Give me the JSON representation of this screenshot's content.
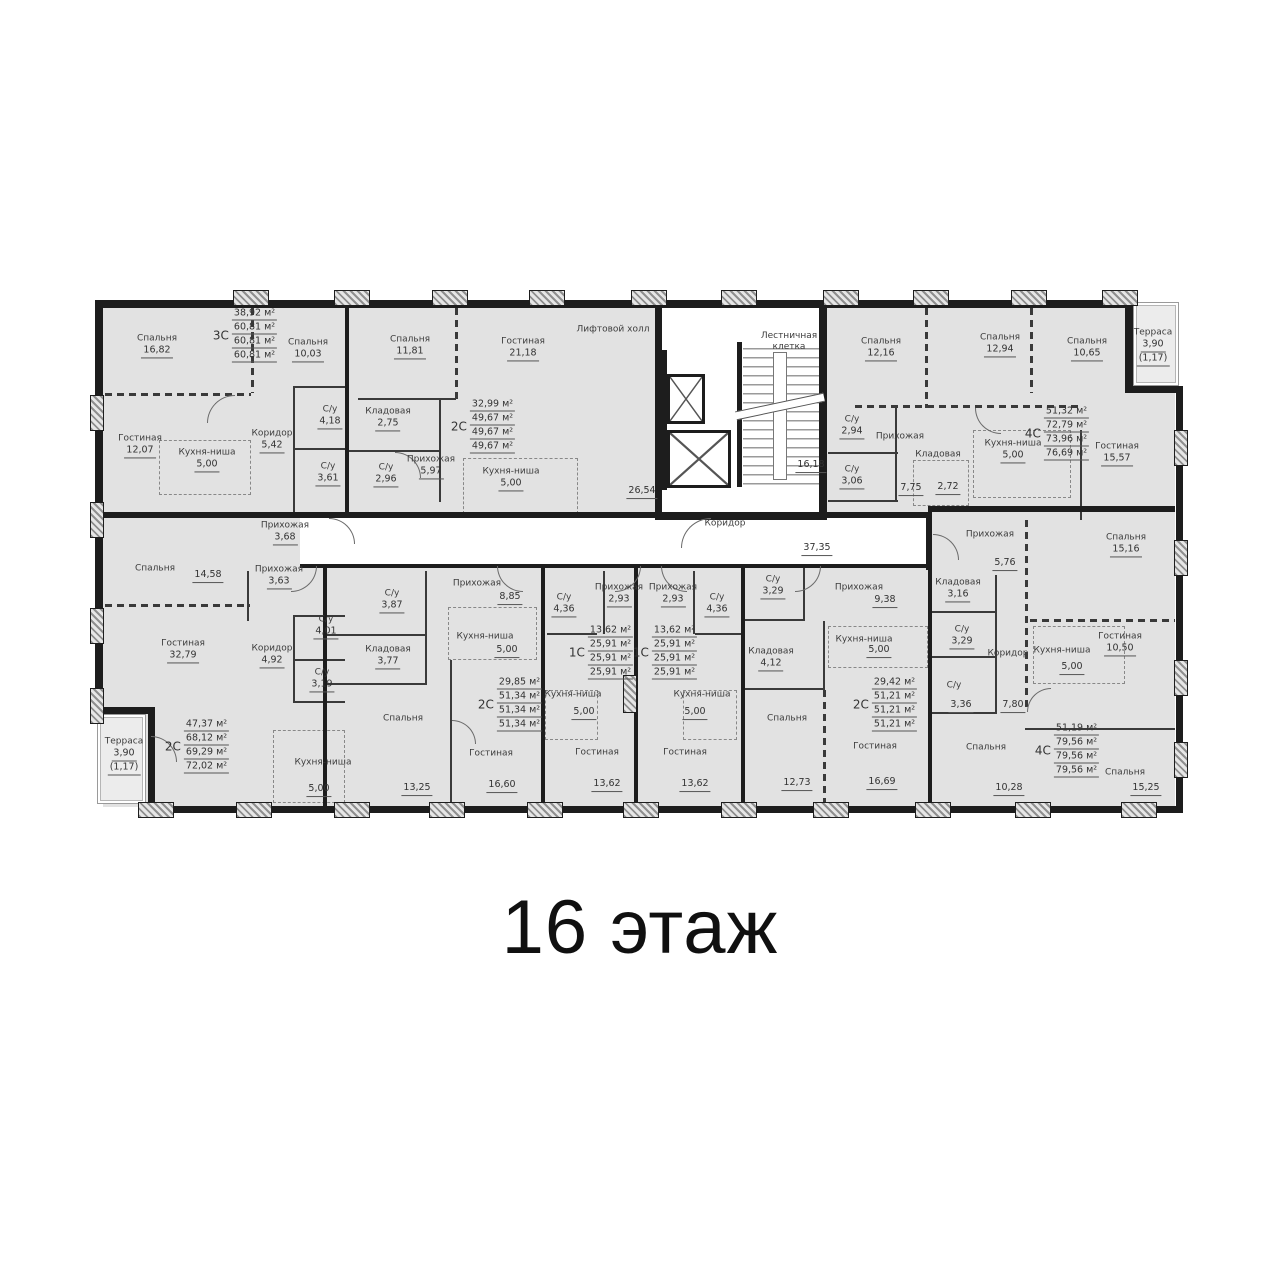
{
  "caption": "16 этаж",
  "core": {
    "elevator_hall": {
      "name": "Лифтовой холл",
      "area": "26,54"
    },
    "stairwell": {
      "name": "Лестничная клетка",
      "area": "16,18"
    },
    "corridor": {
      "name": "Коридор",
      "area": "37,35"
    }
  },
  "apartments": [
    {
      "type": "3С",
      "areas": [
        "38,92 м²",
        "60,81 м²",
        "60,81 м²",
        "60,81 м²"
      ],
      "rooms": [
        {
          "name": "Спальня",
          "area": "16,82"
        },
        {
          "name": "Спальня",
          "area": "10,03"
        },
        {
          "name": "Гостиная",
          "area": "12,07"
        },
        {
          "name": "Кухня-ниша",
          "area": "5,00"
        },
        {
          "name": "Коридор",
          "area": "5,42"
        },
        {
          "name": "С/у",
          "area": "4,18"
        },
        {
          "name": "С/у",
          "area": "3,61"
        },
        {
          "name": "Прихожая",
          "area": "3,68"
        }
      ]
    },
    {
      "type": "2С",
      "areas": [
        "32,99 м²",
        "49,67 м²",
        "49,67 м²",
        "49,67 м²"
      ],
      "rooms": [
        {
          "name": "Спальня",
          "area": "11,81"
        },
        {
          "name": "Гостиная",
          "area": "21,18"
        },
        {
          "name": "Кладовая",
          "area": "2,75"
        },
        {
          "name": "С/у",
          "area": "2,96"
        },
        {
          "name": "Прихожая",
          "area": "5,97"
        },
        {
          "name": "Кухня-ниша",
          "area": "5,00"
        }
      ]
    },
    {
      "type": "4С",
      "areas": [
        "51,32 м²",
        "72,79 м²",
        "73,96 м²",
        "76,69 м²"
      ],
      "rooms": [
        {
          "name": "Спальня",
          "area": "12,16"
        },
        {
          "name": "Спальня",
          "area": "12,94"
        },
        {
          "name": "Спальня",
          "area": "10,65"
        },
        {
          "name": "Терраса",
          "area": "3,90",
          "area2": "(1,17)"
        },
        {
          "name": "С/у",
          "area": "2,94"
        },
        {
          "name": "С/у",
          "area": "3,06"
        },
        {
          "name": "Прихожая",
          "area": "7,75"
        },
        {
          "name": "Кладовая",
          "area": "2,72"
        },
        {
          "name": "Кухня-ниша",
          "area": "5,00"
        },
        {
          "name": "Гостиная",
          "area": "15,57"
        }
      ]
    },
    {
      "type": "2С",
      "areas": [
        "47,37 м²",
        "68,12 м²",
        "69,29 м²",
        "72,02 м²"
      ],
      "rooms": [
        {
          "name": "Спальня",
          "area": "14,58"
        },
        {
          "name": "Прихожая",
          "area": "3,63"
        },
        {
          "name": "Гостиная",
          "area": "32,79"
        },
        {
          "name": "Коридор",
          "area": "4,92"
        },
        {
          "name": "С/у",
          "area": "4,01"
        },
        {
          "name": "С/у",
          "area": "3,19"
        },
        {
          "name": "Кухня-ниша",
          "area": "5,00"
        },
        {
          "name": "Терраса",
          "area": "3,90",
          "area2": "(1,17)"
        }
      ]
    },
    {
      "type": "2С",
      "areas": [
        "29,85 м²",
        "51,34 м²",
        "51,34 м²",
        "51,34 м²"
      ],
      "rooms": [
        {
          "name": "С/у",
          "area": "3,87"
        },
        {
          "name": "Прихожая",
          "area": "8,85"
        },
        {
          "name": "Кухня-ниша",
          "area": "5,00"
        },
        {
          "name": "Кладовая",
          "area": "3,77"
        },
        {
          "name": "Спальня",
          "area": "13,25"
        },
        {
          "name": "Гостиная",
          "area": "16,60"
        }
      ]
    },
    {
      "type": "1С",
      "areas": [
        "13,62 м²",
        "25,91 м²",
        "25,91 м²",
        "25,91 м²"
      ],
      "rooms": [
        {
          "name": "С/у",
          "area": "4,36"
        },
        {
          "name": "Прихожая",
          "area": "2,93"
        },
        {
          "name": "Кухня-ниша",
          "area": "5,00"
        },
        {
          "name": "Гостиная",
          "area": "13,62"
        }
      ]
    },
    {
      "type": "1С",
      "areas": [
        "13,62 м²",
        "25,91 м²",
        "25,91 м²",
        "25,91 м²"
      ],
      "rooms": [
        {
          "name": "Прихожая",
          "area": "2,93"
        },
        {
          "name": "С/у",
          "area": "4,36"
        },
        {
          "name": "Кухня-ниша",
          "area": "5,00"
        },
        {
          "name": "Гостиная",
          "area": "13,62"
        }
      ]
    },
    {
      "type": "2С",
      "areas": [
        "29,42 м²",
        "51,21 м²",
        "51,21 м²",
        "51,21 м²"
      ],
      "rooms": [
        {
          "name": "С/у",
          "area": "3,29"
        },
        {
          "name": "Прихожая",
          "area": "9,38"
        },
        {
          "name": "Кладовая",
          "area": "4,12"
        },
        {
          "name": "Кухня-ниша",
          "area": "5,00"
        },
        {
          "name": "Спальня",
          "area": "12,73"
        },
        {
          "name": "Гостиная",
          "area": "16,69"
        }
      ]
    },
    {
      "type": "4С",
      "areas": [
        "51,19 м²",
        "79,56 м²",
        "79,56 м²",
        "79,56 м²"
      ],
      "rooms": [
        {
          "name": "Прихожая",
          "area": "5,76"
        },
        {
          "name": "Кладовая",
          "area": "3,16"
        },
        {
          "name": "С/у",
          "area": "3,29"
        },
        {
          "name": "Коридор",
          "area": "7,80"
        },
        {
          "name": "С/у",
          "area": "3,36"
        },
        {
          "name": "Спальня",
          "area": "10,28"
        },
        {
          "name": "Спальня",
          "area": "15,16"
        },
        {
          "name": "Гостиная",
          "area": "10,50"
        },
        {
          "name": "Кухня-ниша",
          "area": "5,00"
        },
        {
          "name": "Спальня",
          "area": "15,25"
        }
      ]
    }
  ]
}
